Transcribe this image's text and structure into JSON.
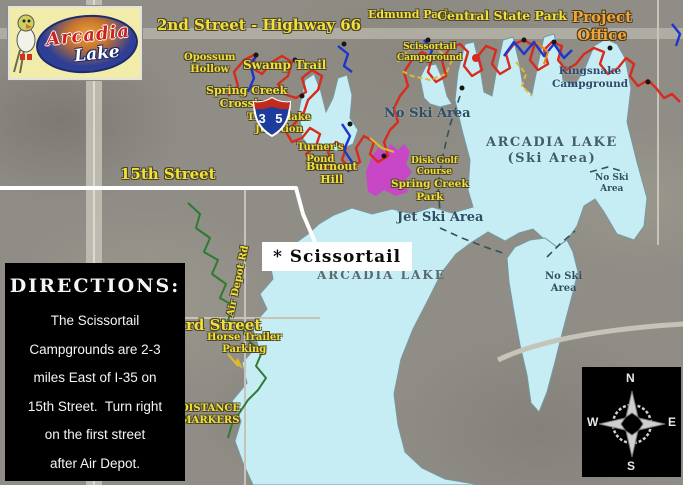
{
  "logo": {
    "line1": "Arcadia",
    "line2": "Lake"
  },
  "interstate_shield": {
    "number": "3 5"
  },
  "labels": {
    "street_2nd": "2nd Street - Highway 66",
    "edmund_park": "Edmund Park",
    "central_state_park": "Central State Park",
    "project_office": "Project\nOffice",
    "opossum_hollow": "Opossum\nHollow",
    "swamp_trail": "Swamp Trail",
    "spring_creek_crossing": "Spring Creek\nCrossing",
    "timberlake_junction": "Timberlake\nJunction",
    "turners_pond": "Turner's\nPond",
    "burnout_hill": "Burnout\nHill",
    "scissortail_campground": "Scissortail\nCampground",
    "kingsnake_campground": "Kingsnake\nCampground",
    "disk_golf_course": "Disk Golf\nCourse",
    "spring_creek_park": "Spring Creek\nPark",
    "no_ski_area_nw": "No Ski Area",
    "arcadia_lake_ski": "ARCADIA LAKE\n(Ski Area)",
    "no_ski_area_e": "No Ski\nArea",
    "no_ski_area_se": "No Ski\nArea",
    "jet_ski_area": "Jet Ski Area",
    "arcadia_lake_south": "ARCADIA LAKE",
    "street_15th": "15th Street",
    "air_depot_rd": "Air Depot Rd",
    "street_33rd": "rd Street",
    "horse_trailer_parking": "Horse Trailer\nParking",
    "distance_markers": "DISTANCE\nMARKERS"
  },
  "scissortail_marker": {
    "text": "* Scissortail"
  },
  "directions": {
    "title": "DIRECTIONS:",
    "body": "The Scissortail\nCampgrounds are 2-3\nmiles East of I-35 on\n15th Street.  Turn right\non the first street\nafter Air Depot."
  },
  "compass": {
    "north": "N",
    "east": "E",
    "south": "S",
    "west": "W"
  },
  "colors": {
    "lake": "#c6edf3",
    "terrain": "#8f8d85",
    "trail_red": "#d92a1e",
    "trail_blue": "#1c35cf",
    "trail_green": "#2f7a33",
    "trail_yellow": "#e0b92f",
    "park_highlight": "#cf3ecf",
    "label_yellow": "#f2df3a",
    "label_navy": "#2e4e66",
    "route_white": "#ffffff",
    "box_black": "#000000",
    "logo_yellow": "#f2ecab",
    "logo_blue": "#2e3f95",
    "logo_red": "#cc2222",
    "office_orange": "#f0a43c"
  }
}
